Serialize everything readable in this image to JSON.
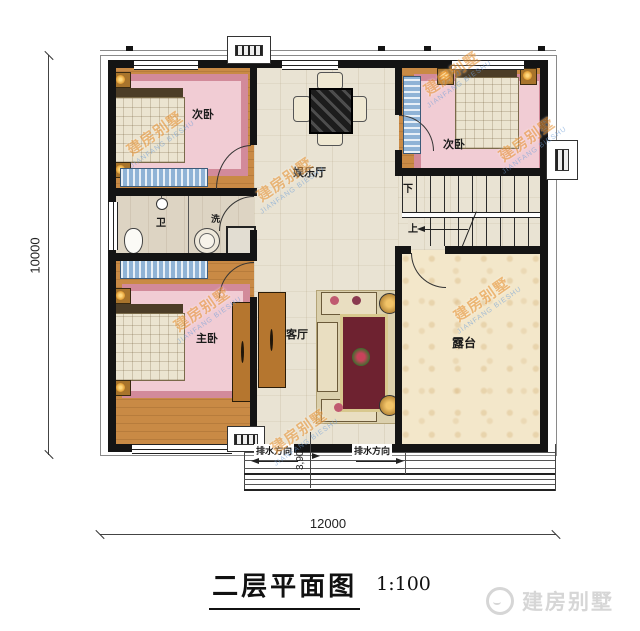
{
  "plan": {
    "rooms": {
      "bedroom_top_left": {
        "label": "次卧"
      },
      "bedroom_top_right": {
        "label": "次卧"
      },
      "bedroom_master": {
        "label": "主卧"
      },
      "entertainment_hall": {
        "label": "娱乐厅"
      },
      "living_room": {
        "label": "客厅"
      },
      "toilet": {
        "label": "卫"
      },
      "laundry": {
        "label": "洗"
      },
      "terrace": {
        "label": "露台"
      }
    },
    "stairs": {
      "up_label": "上",
      "down_label": "下"
    },
    "annotations": {
      "drainage_left": "排水方向",
      "drainage_right": "排水方向"
    },
    "dimensions": {
      "overall_width": "12000",
      "overall_height": "10000",
      "porch_depth": "3,900"
    }
  },
  "title_block": {
    "title": "二层平面图",
    "scale": "1:100"
  },
  "watermark": {
    "cn": "建房别墅",
    "en": "JIANFANG BIESHU"
  },
  "logo": {
    "brand": "建房别墅"
  },
  "colors": {
    "wall": "#141414",
    "wood_floor": "#c98a45",
    "tile_floor": "#e9e3d3",
    "terrace_floor": "#f3e7ca",
    "rug_pink": "#d28a9a",
    "bench_blue": "#8fb3d6",
    "watermark_orange": "#e8973c",
    "watermark_blue": "#6f9fd8",
    "logo_gray": "#d6d6d6"
  }
}
